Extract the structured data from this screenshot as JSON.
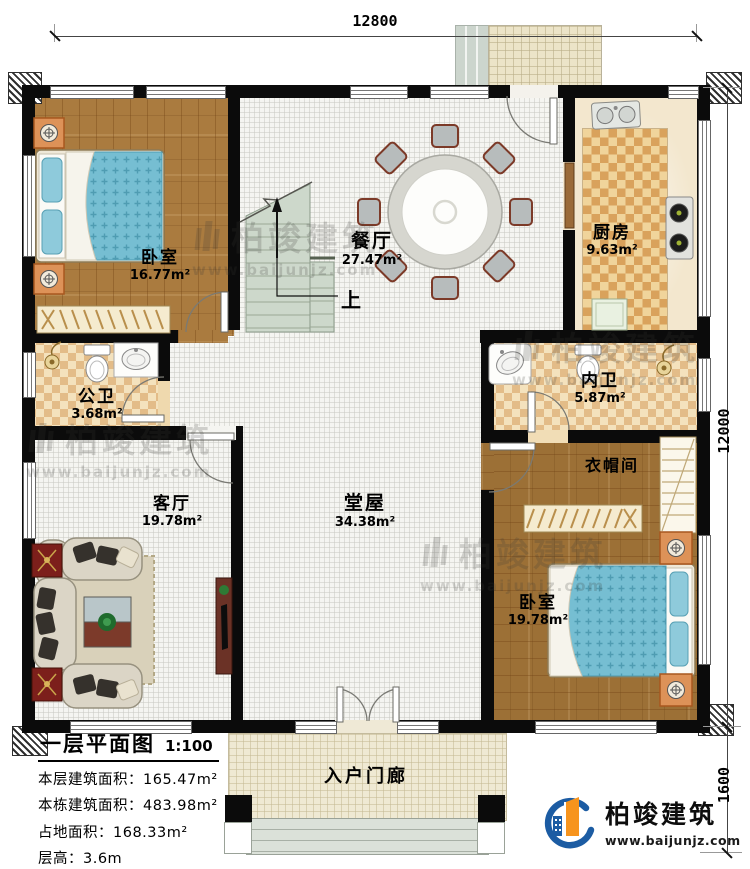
{
  "plan": {
    "dimensions": {
      "width_top": "12800",
      "height_right": "12000",
      "porch_height": "1600"
    },
    "stairs_up_label": "上",
    "rooms": {
      "bedroom1": {
        "name": "卧室",
        "area": "16.77m²"
      },
      "dining": {
        "name": "餐厅",
        "area": "27.47m²"
      },
      "kitchen": {
        "name": "厨房",
        "area": "9.63m²"
      },
      "public_bath": {
        "name": "公卫",
        "area": "3.68m²"
      },
      "ensuite_bath": {
        "name": "内卫",
        "area": "5.87m²"
      },
      "living": {
        "name": "客厅",
        "area": "19.78m²"
      },
      "hall": {
        "name": "堂屋",
        "area": "34.38m²"
      },
      "cloakroom": {
        "name": "衣帽间"
      },
      "bedroom2": {
        "name": "卧室",
        "area": "19.78m²"
      },
      "porch": {
        "name": "入户门廊"
      }
    }
  },
  "info": {
    "title": "一层平面图",
    "scale": "1:100",
    "rows": [
      {
        "label": "本层建筑面积：",
        "value": "165.47m²"
      },
      {
        "label": "本栋建筑面积：",
        "value": "483.98m²"
      },
      {
        "label": "占地面积：",
        "value": "168.33m²"
      },
      {
        "label": "层高：",
        "value": "3.6m"
      }
    ]
  },
  "brand": {
    "name": "柏竣建筑",
    "website": "www.baijunjz.com"
  },
  "watermark": {
    "name": "柏竣建筑",
    "website": "www.baijunjz.com"
  },
  "colors": {
    "wall": "#0b0b0b",
    "wood": "#aa7b3f",
    "bed_blue": "#76bed2",
    "accent_blue": "#1c5ca3",
    "accent_orange": "#f7941d"
  }
}
